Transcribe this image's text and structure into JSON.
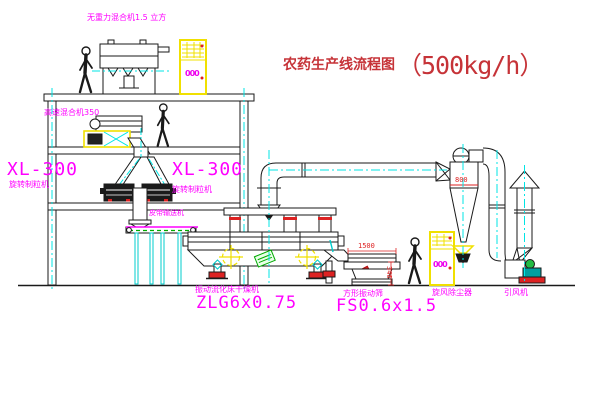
{
  "title": {
    "text": "农药生产线流程图",
    "capacity": "（500kg/h）"
  },
  "equipment_labels": {
    "no_gravity_mixer": "无重力混合机1.5 立方",
    "high_speed_mixer": "高速混合机350",
    "granulator_left": {
      "model": "XL-300",
      "name": "旋转制粒机"
    },
    "granulator_right": {
      "model": "XL-300",
      "name": "旋转制粒机"
    },
    "belt_conveyor": "皮带输送机",
    "fluid_bed_dryer": {
      "name": "振动流化床干燥机",
      "model": "ZLG6x0.75"
    },
    "square_sieve": {
      "name": "方形振动筛",
      "model": "FS0.6x1.5"
    },
    "cyclone_dust_collector": "旋风除尘器",
    "induced_draft_fan": "引风机"
  },
  "dimensions": {
    "sieve_length": "1500",
    "sieve_height": "346",
    "cyclone_marking": "800"
  },
  "control_panel_symbol": "000",
  "colors": {
    "label_magenta": "#ff00ff",
    "title_red": "#c63338",
    "centerline_cyan": "#00e5e5",
    "highlight_yellow": "#f0e000",
    "dimension_red": "#dd2222",
    "stamp_green": "#00aa00",
    "line_black": "#1a1a1a"
  }
}
